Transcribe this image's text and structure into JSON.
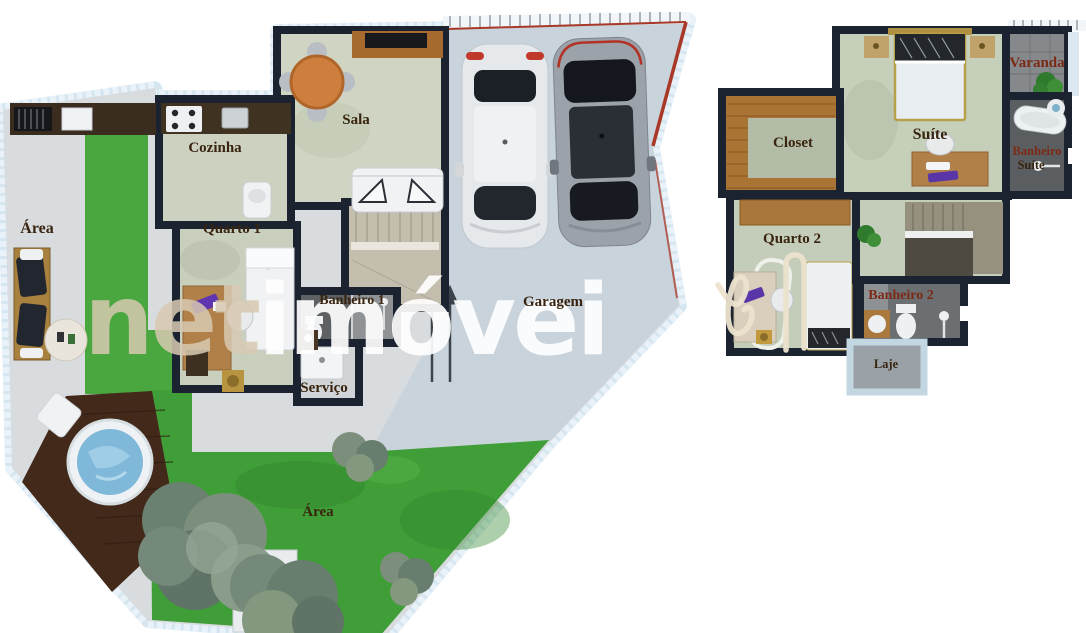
{
  "title": "floor-plan-render",
  "watermark": {
    "part1": "net",
    "part2": "imóvei"
  },
  "floor1": {
    "area_left": "Área",
    "cozinha": "Cozinha",
    "sala": "Sala",
    "quarto1": "Quarto 1",
    "banheiro1": "Banheiro 1",
    "servico": "Serviço",
    "garagem": "Garagem",
    "area_garden": "Área"
  },
  "floor2": {
    "closet": "Closet",
    "suite": "Suíte",
    "varanda": "Varanda",
    "banheiro_suite_line1": "Banheiro",
    "banheiro_suite_line2": "Suíte",
    "quarto2": "Quarto 2",
    "banheiro2": "Banheiro 2",
    "laje": "Laje"
  },
  "colors": {
    "wall": "#1c2330",
    "floor_marble": "#cfd5c2",
    "garage_concrete": "#c9d3db",
    "patio": "#d9dcdf",
    "grass": "#3f9e37",
    "deck_wood": "#42291a",
    "lot_bevel": "#e9f2f8",
    "roof_edge_red": "#a83828",
    "watermark_tan": "#d8cab2",
    "watermark_white": "#ffffff",
    "label_brown": "#38240f",
    "label_red": "#7c2a16"
  }
}
